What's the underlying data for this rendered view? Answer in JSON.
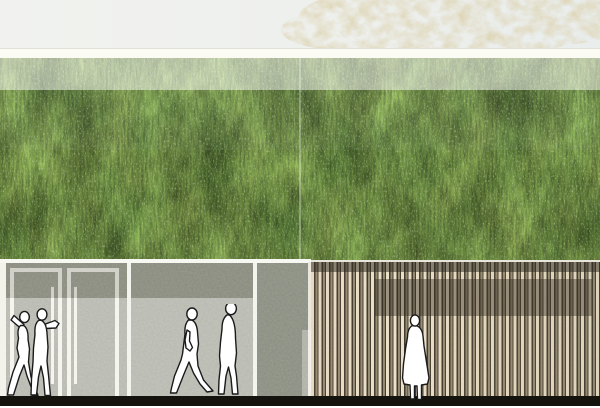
{
  "meta": {
    "kind": "architectural-elevation-rendering",
    "description": "Street elevation of a building: two upper storeys fully covered by a living green facade, ground floor with glazed double entrance doors in a concrete wall on the left and vertical timber slat cladding on the right, faint sketched tree behind the roof line, white human silhouettes for scale on a black ground line."
  },
  "labels": {
    "sky": "sky backdrop",
    "tree": "sketched tree canopy behind building",
    "parapet": "white roof parapet band",
    "green_wall": "living green facade (vegetation wall)",
    "green_wall_light_band": "sun-washed upper strip of green facade",
    "panel_seam": "green-wall panel joint",
    "concrete_wall": "ground-floor concrete wall",
    "entrance_doors": "glazed double entrance doors",
    "door_left": "entrance door leaf left",
    "door_right": "entrance door leaf right",
    "door_handle": "door pull handle",
    "wall_joint": "facade joint line",
    "timber_cladding": "vertical timber slat cladding",
    "slat_top_band": "dark reveal above timber slats",
    "slat_window_band": "window band behind timber slats",
    "ground_line": "black ground line",
    "figures_entrance_pair": "silhouette pair at entrance",
    "figures_walking_pair": "walking silhouette pair",
    "figure_standing": "standing silhouette at timber facade"
  },
  "palette": {
    "sky": "#eef0ed",
    "parapet_white": "#fbfbf4",
    "tree_beige": "#ddd3b8",
    "vegetation_base": "#63803b",
    "vegetation_highlight": "#c3cbae",
    "vegetation_shadow": "#46512f",
    "concrete": "#a9ab9f",
    "concrete_light_zone": "#c3c4bc",
    "door_frame_white": "#f1f0e8",
    "slat_light": "#f0e6d0",
    "slat_mid": "#9b9078",
    "slat_gap_dark": "#40392d",
    "ground_black": "#14130e",
    "figure_fill": "#ffffff",
    "figure_outline": "#1a1a1a"
  },
  "composition": {
    "image_size": "600x408",
    "bands_px": {
      "sky": [
        0,
        50
      ],
      "parapet": [
        48,
        58
      ],
      "green_wall": [
        58,
        262
      ],
      "green_wall_light_overlay": [
        58,
        90
      ],
      "ground_floor": [
        262,
        396
      ],
      "ground_line": [
        396,
        406
      ]
    },
    "ground_floor_split_x": 311,
    "door_positions_x": [
      10,
      67
    ],
    "joint_lines_x": [
      0,
      127,
      253
    ],
    "figure_count": 5
  }
}
